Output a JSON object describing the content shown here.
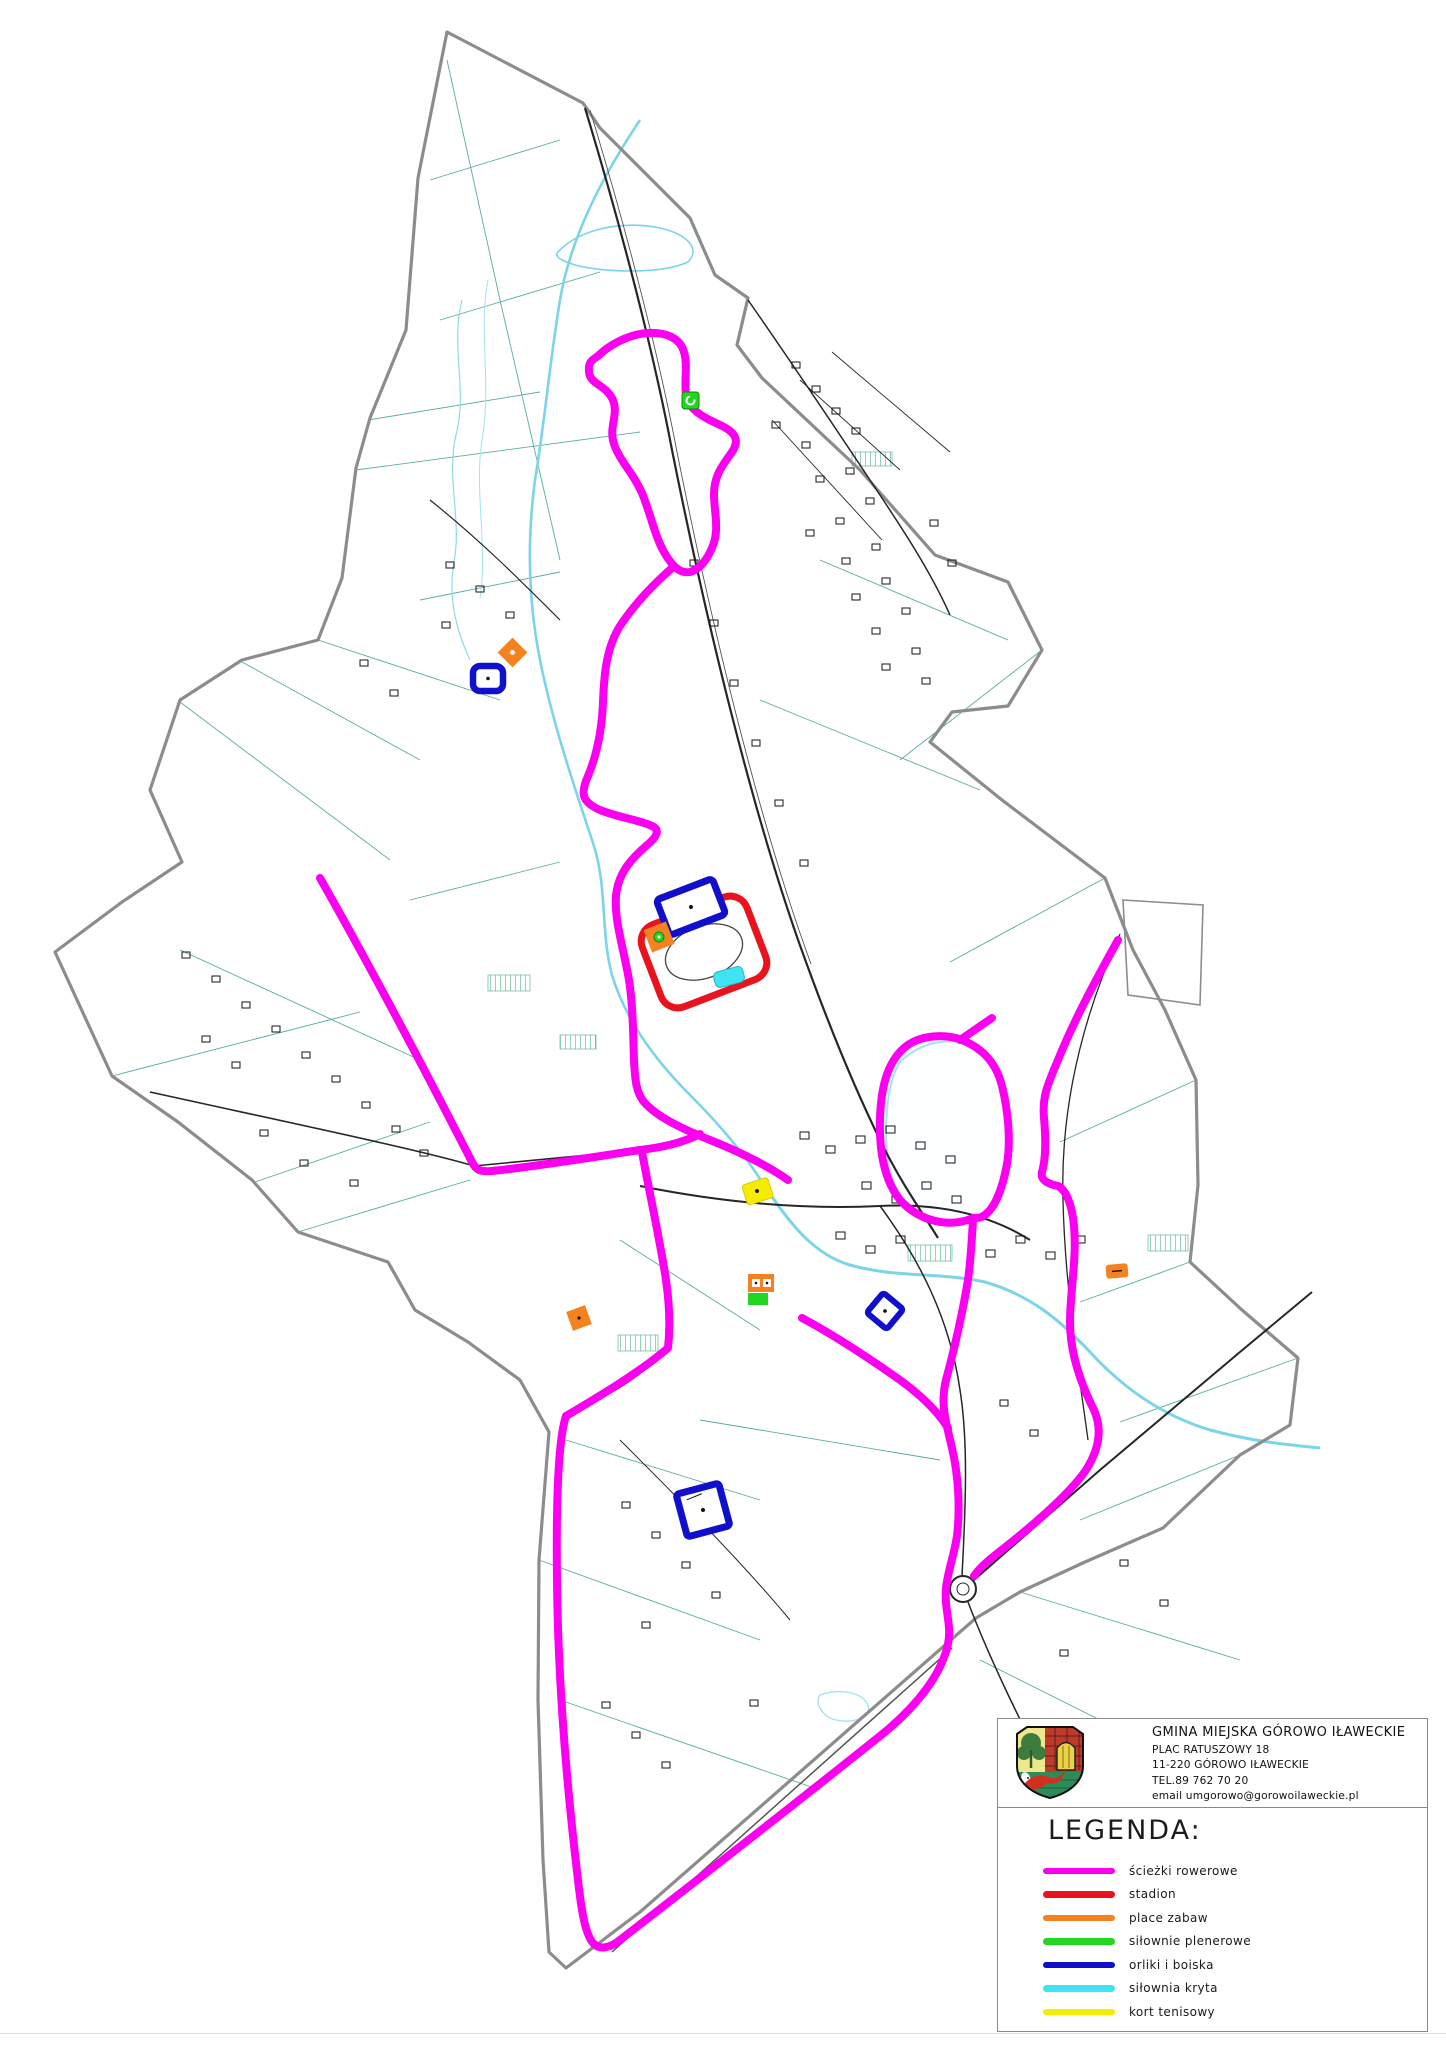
{
  "colors": {
    "bike_path": "#FB00F0",
    "stadium": "#E9131D",
    "playground": "#F58220",
    "outdoor_gym": "#22D622",
    "pitch": "#1010CC",
    "indoor_gym": "#3FE3F2",
    "tennis": "#F6EC00",
    "boundary": "#8C8C8C",
    "road": "#262626",
    "stream": "#7CD4E8",
    "field_line": "#3C9C94"
  },
  "info_box": {
    "municipality": "GMINA MIEJSKA GÓROWO IŁAWECKIE",
    "address_line1": "PLAC RATUSZOWY 18",
    "address_line2": "11-220 GÓROWO IŁAWECKIE",
    "phone": "TEL.89 762 70 20",
    "email": "email  umgorowo@gorowoilaweckie.pl"
  },
  "legend": {
    "title": "LEGENDA:",
    "items": [
      {
        "label": "ścieżki rowerowe",
        "color": "#FB00F0"
      },
      {
        "label": "stadion",
        "color": "#E9131D"
      },
      {
        "label": "place zabaw",
        "color": "#F58220"
      },
      {
        "label": "siłownie plenerowe",
        "color": "#22D622"
      },
      {
        "label": "orliki i boiska",
        "color": "#1010CC"
      },
      {
        "label": "siłownia kryta",
        "color": "#3FE3F2"
      },
      {
        "label": "kort tenisowy",
        "color": "#F6EC00"
      }
    ]
  }
}
